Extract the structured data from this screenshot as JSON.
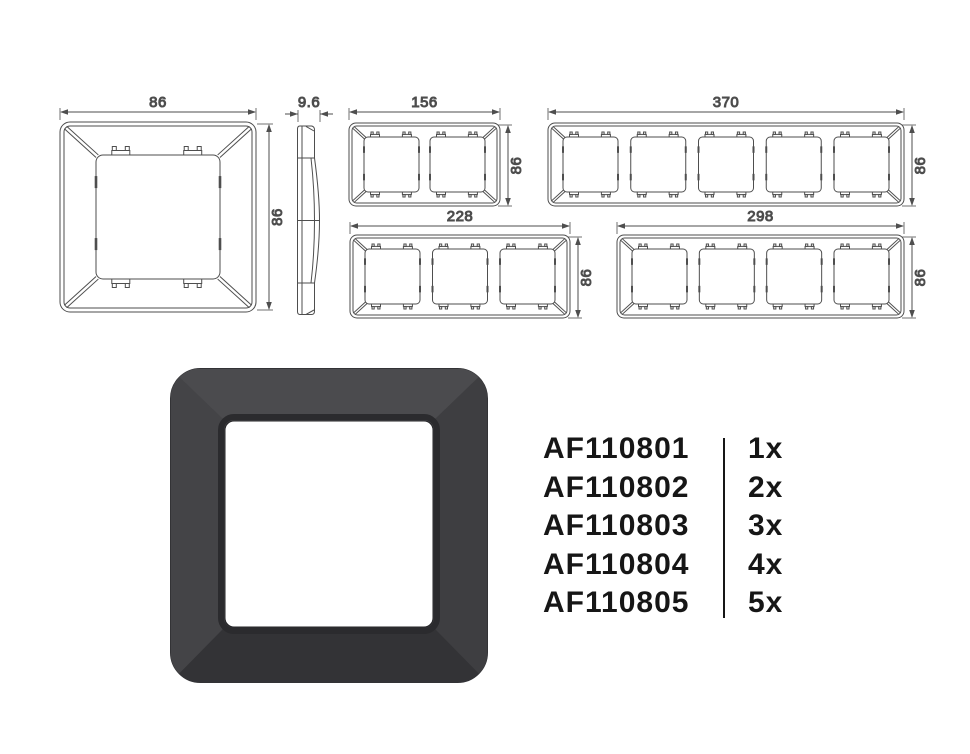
{
  "diagram": {
    "stroke_color": "#4e4e4e",
    "dim_text_color": "#4a4a4a",
    "views": [
      {
        "name": "front-1-gang",
        "gangs": 1,
        "dim_width": "86",
        "dim_height": "86"
      },
      {
        "name": "side-profile",
        "dim_width": "9.6"
      },
      {
        "name": "front-2-gang",
        "gangs": 2,
        "dim_width": "156",
        "dim_height": "86"
      },
      {
        "name": "front-5-gang",
        "gangs": 5,
        "dim_width": "370",
        "dim_height": "86"
      },
      {
        "name": "front-3-gang",
        "gangs": 3,
        "dim_width": "228",
        "dim_height": "86"
      },
      {
        "name": "front-4-gang",
        "gangs": 4,
        "dim_width": "298",
        "dim_height": "86"
      }
    ]
  },
  "product": {
    "frame_color": "#424245",
    "window_color": "#ffffff",
    "text_color": "#161616",
    "items": [
      {
        "code": "AF110801",
        "qty": "1x"
      },
      {
        "code": "AF110802",
        "qty": "2x"
      },
      {
        "code": "AF110803",
        "qty": "3x"
      },
      {
        "code": "AF110804",
        "qty": "4x"
      },
      {
        "code": "AF110805",
        "qty": "5x"
      }
    ]
  }
}
